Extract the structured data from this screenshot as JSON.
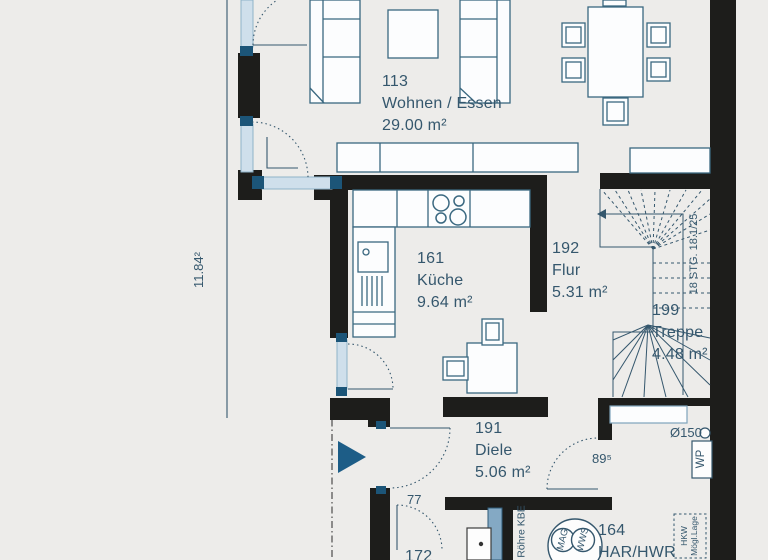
{
  "plan": {
    "title": "Erdgeschoss Grundriss",
    "rooms": [
      {
        "id": "113",
        "name": "Wohnen / Essen",
        "area": "29.00 m²"
      },
      {
        "id": "161",
        "name": "Küche",
        "area": "9.64 m²"
      },
      {
        "id": "192",
        "name": "Flur",
        "area": "5.31 m²"
      },
      {
        "id": "199",
        "name": "Treppe",
        "area": "4.48 m²"
      },
      {
        "id": "191",
        "name": "Diele",
        "area": "5.06 m²"
      },
      {
        "id": "164",
        "name": "HAR/HWR",
        "area": ""
      },
      {
        "id": "172",
        "name": "",
        "area": ""
      }
    ],
    "annotations": {
      "stair_note": "18 STG. 18.1/25",
      "dim_left": "11.84²",
      "door_width_inner": "77",
      "door_width_har": "89⁵",
      "duct": "Ø150",
      "heat_pump": "WP",
      "hkw_line1": "HKW",
      "hkw_line2": "Mögl.Lage",
      "pipe": "Röhre KBE",
      "tank1": "MAG",
      "tank2": "WWS"
    },
    "colors": {
      "background": "#edecea",
      "wall": "#1d1d1b",
      "line": "#35576d",
      "window_fill": "#cfdfeb",
      "window_end": "#1c5578",
      "shaft": "#84a9c4",
      "entry_arrow": "#1d5d87"
    }
  }
}
